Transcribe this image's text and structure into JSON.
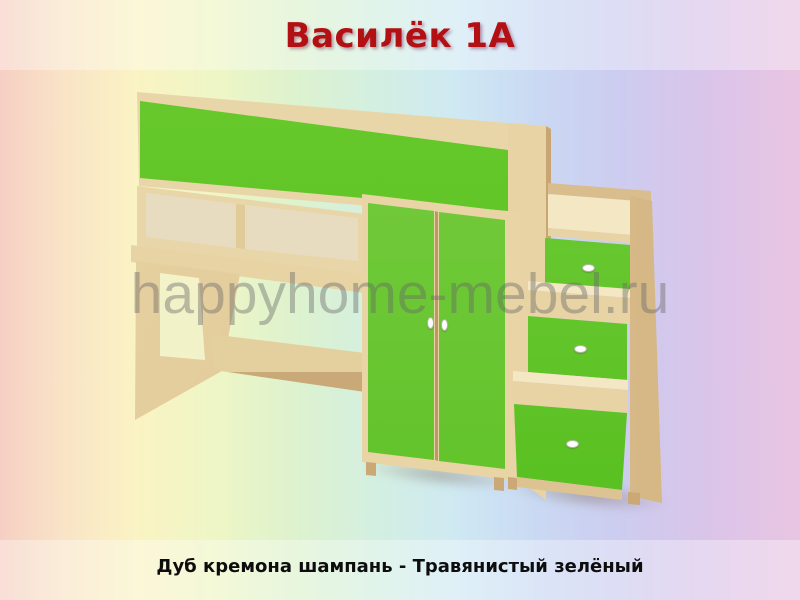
{
  "header": {
    "title": "Василёк 1А"
  },
  "watermark": {
    "text": "happyhome-mebel.ru"
  },
  "footer": {
    "caption": "Дуб кремона шампань - Травянистый зелёный"
  },
  "colors": {
    "title_red": "#b21013",
    "caption_black": "#0d0d0d",
    "watermark_gray": "#696969",
    "facade_green": "#63c52a",
    "wood_light": "#e8d4a4",
    "background_stops": [
      "#f6cfc4",
      "#faf3c4",
      "#ddf2ce",
      "#cfe9f3",
      "#cccdf0",
      "#e9c5e2"
    ]
  }
}
